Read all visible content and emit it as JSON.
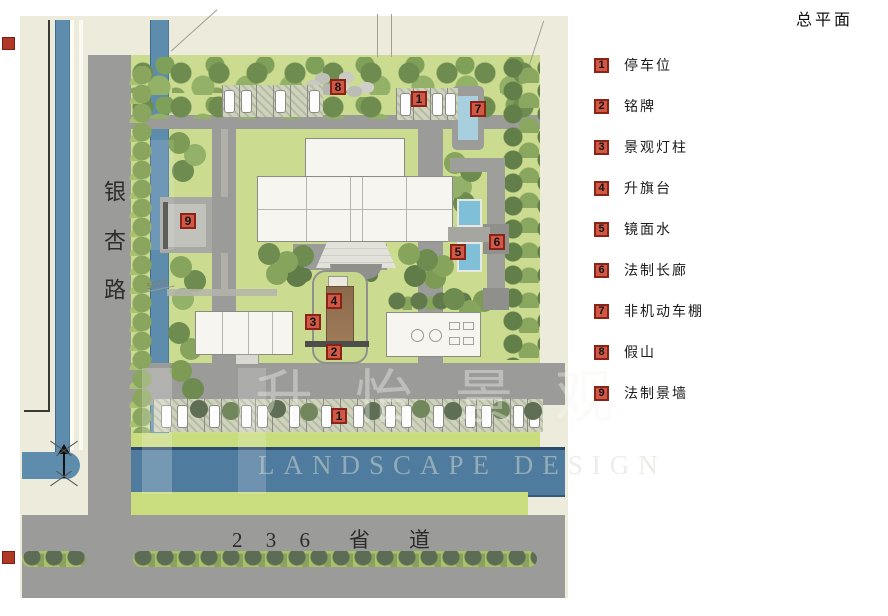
{
  "title": "总平面",
  "legend": [
    {
      "num": "1",
      "label": "停车位"
    },
    {
      "num": "2",
      "label": "铭牌"
    },
    {
      "num": "3",
      "label": "景观灯柱"
    },
    {
      "num": "4",
      "label": "升旗台"
    },
    {
      "num": "5",
      "label": "镜面水"
    },
    {
      "num": "6",
      "label": "法制长廊"
    },
    {
      "num": "7",
      "label": "非机动车棚"
    },
    {
      "num": "8",
      "label": "假山"
    },
    {
      "num": "9",
      "label": "法制景墙"
    }
  ],
  "roads": {
    "west": "银杏路",
    "south_number": "2 3 6",
    "south_char1": "省",
    "south_char2": "道"
  },
  "map_markers": [
    {
      "num": "8",
      "x": 330,
      "y": 79
    },
    {
      "num": "1",
      "x": 411,
      "y": 91
    },
    {
      "num": "7",
      "x": 470,
      "y": 101
    },
    {
      "num": "9",
      "x": 180,
      "y": 213
    },
    {
      "num": "6",
      "x": 489,
      "y": 234
    },
    {
      "num": "5",
      "x": 450,
      "y": 244
    },
    {
      "num": "4",
      "x": 326,
      "y": 293
    },
    {
      "num": "3",
      "x": 305,
      "y": 314
    },
    {
      "num": "2",
      "x": 326,
      "y": 344
    },
    {
      "num": "1",
      "x": 331,
      "y": 408
    }
  ],
  "dimension_label": "5000",
  "watermark": {
    "cn": "升怡景观",
    "en": "LANDSCAPE  DESIGN"
  },
  "colors": {
    "marker_bg": "#d05844",
    "marker_border": "#8a2418",
    "road": "#9b9b99",
    "lawn": "#cbdb90",
    "canal": "#5d8cad",
    "south_water": "#4f7b9e",
    "cream": "#edecdc",
    "green_strip": "#c9dc7e"
  }
}
